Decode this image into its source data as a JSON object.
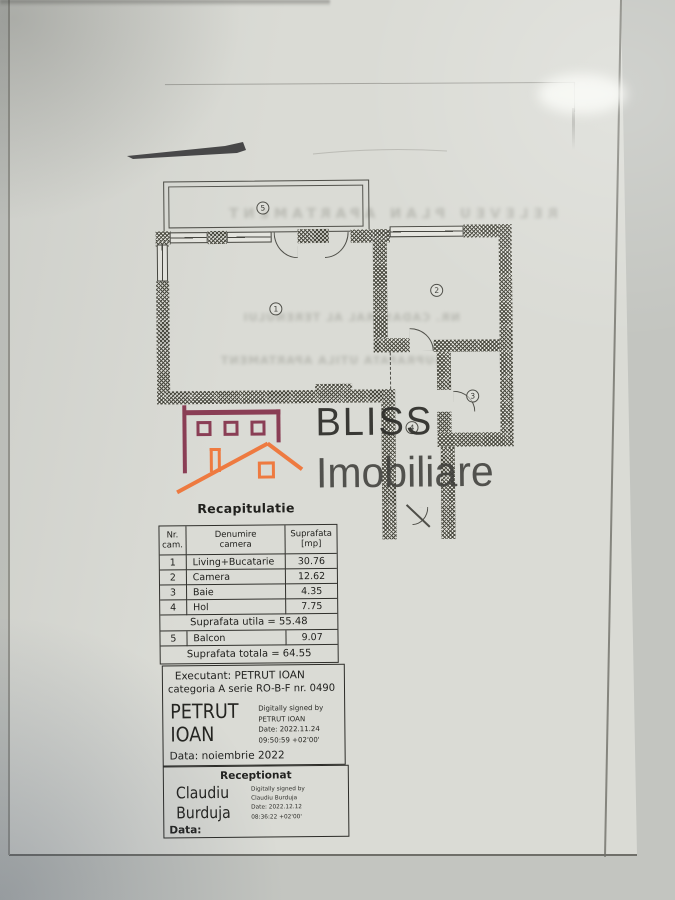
{
  "logo": {
    "brand_top": "BLISS",
    "brand_bottom": "Imobiliare",
    "maroon": "#8a3e55",
    "orange": "#ee7a40"
  },
  "plan": {
    "labels": [
      "1",
      "2",
      "3",
      "4",
      "5"
    ]
  },
  "ghost": {
    "line1": "RELEVEU PLAN APARTAMENT",
    "line2": "NR. CADASTRAL AL TERENULUI",
    "line3": "SUPRAFATA UTILA APARTAMENT"
  },
  "recap": {
    "title": "Recapitulatie",
    "table": {
      "headers": [
        {
          "line1": "Nr.",
          "line2": "cam."
        },
        {
          "line1": "Denumire",
          "line2": "camera"
        },
        {
          "line1": "Suprafata",
          "line2": "[mp]"
        }
      ],
      "rows": [
        [
          "1",
          "Living+Bucatarie",
          "30.76"
        ],
        [
          "2",
          "Camera",
          "12.62"
        ],
        [
          "3",
          "Baie",
          "4.35"
        ],
        [
          "4",
          "Hol",
          "7.75"
        ]
      ],
      "subtotal": "Suprafata utila = 55.48",
      "balcon_row": [
        "5",
        "Balcon",
        "9.07"
      ],
      "total": "Suprafata totala = 64.55"
    }
  },
  "executant": {
    "line1": "Executant: PETRUT IOAN",
    "line2": "categoria A serie RO-B-F nr. 0490",
    "signature_name": "PETRUT\nIOAN",
    "digital": [
      "Digitally signed by",
      "PETRUT IOAN",
      "Date: 2022.11.24",
      "09:50:59 +02'00'"
    ],
    "date_line": "Data: noiembrie 2022"
  },
  "receptionat": {
    "title": "Receptionat",
    "signature_name": "Claudiu\nBurduja",
    "digital": [
      "Digitally signed by",
      "Claudiu Burduja",
      "Date: 2022.12.12",
      "08:36:22 +02'00'"
    ],
    "date_line": "Data:"
  },
  "colors": {
    "paper": "#dadbd5",
    "backdrop": "#c3c5c0",
    "ink": "#2c2c28"
  }
}
